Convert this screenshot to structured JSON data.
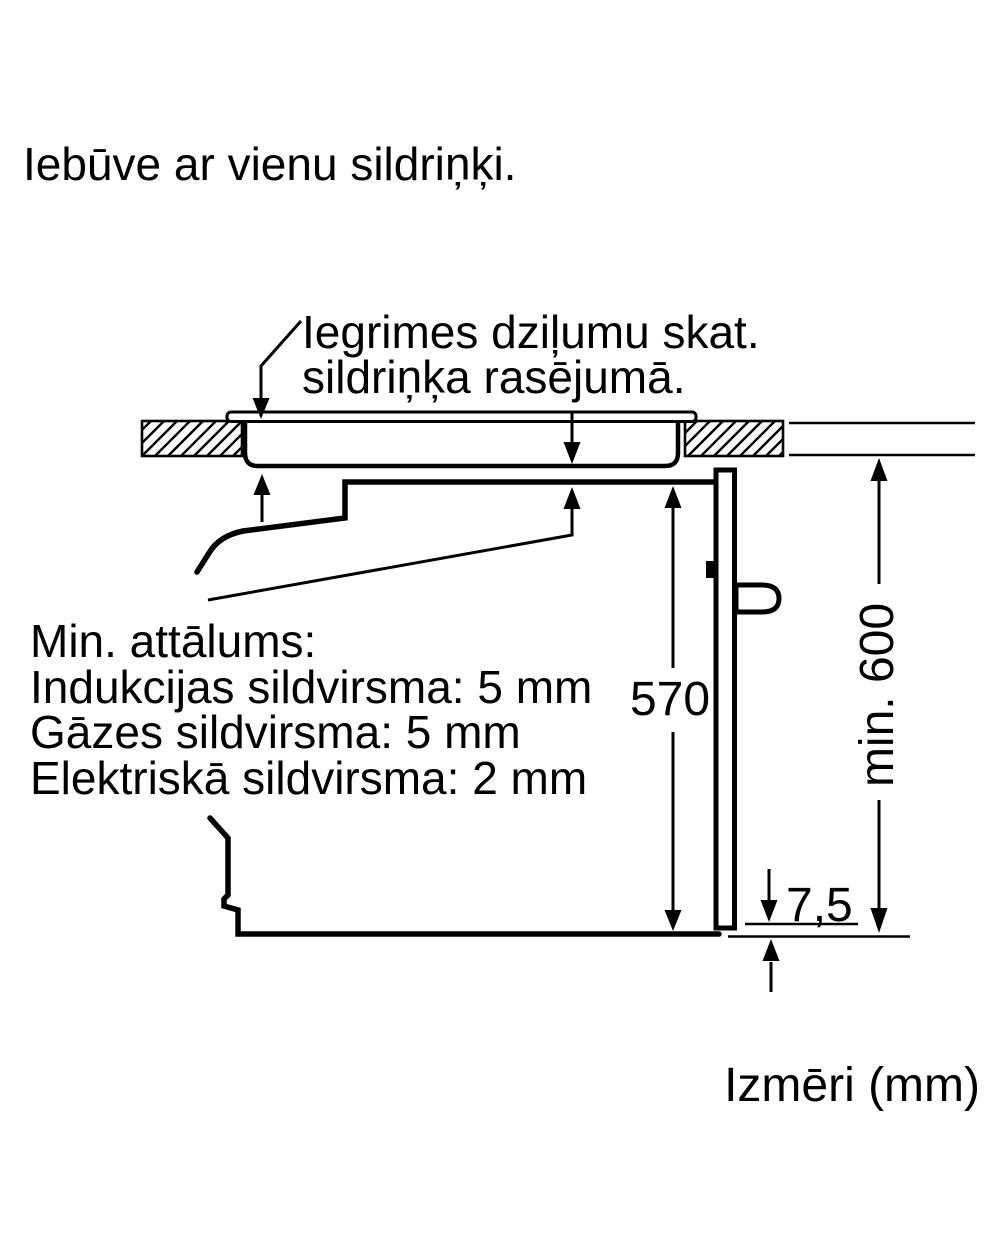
{
  "page": {
    "background_color": "#ffffff",
    "ink_color": "#010101"
  },
  "title": "Iebūve ar vienu sildriņķi.",
  "annotation": {
    "line1": "Iegrimes dziļumu skat.",
    "line2": "sildriņķa rasējumā."
  },
  "min_distance": {
    "heading": "Min. attālums:",
    "items": [
      "Indukcijas sildvirsma: 5 mm",
      "Gāzes sildvirsma: 5 mm",
      "Elektriskā sildvirsma: 2 mm"
    ]
  },
  "dimensions": {
    "oven_niche_height": "570",
    "min_installation_height": "min. 600",
    "bottom_gap": "7,5"
  },
  "footer": "Izmēri (mm)"
}
